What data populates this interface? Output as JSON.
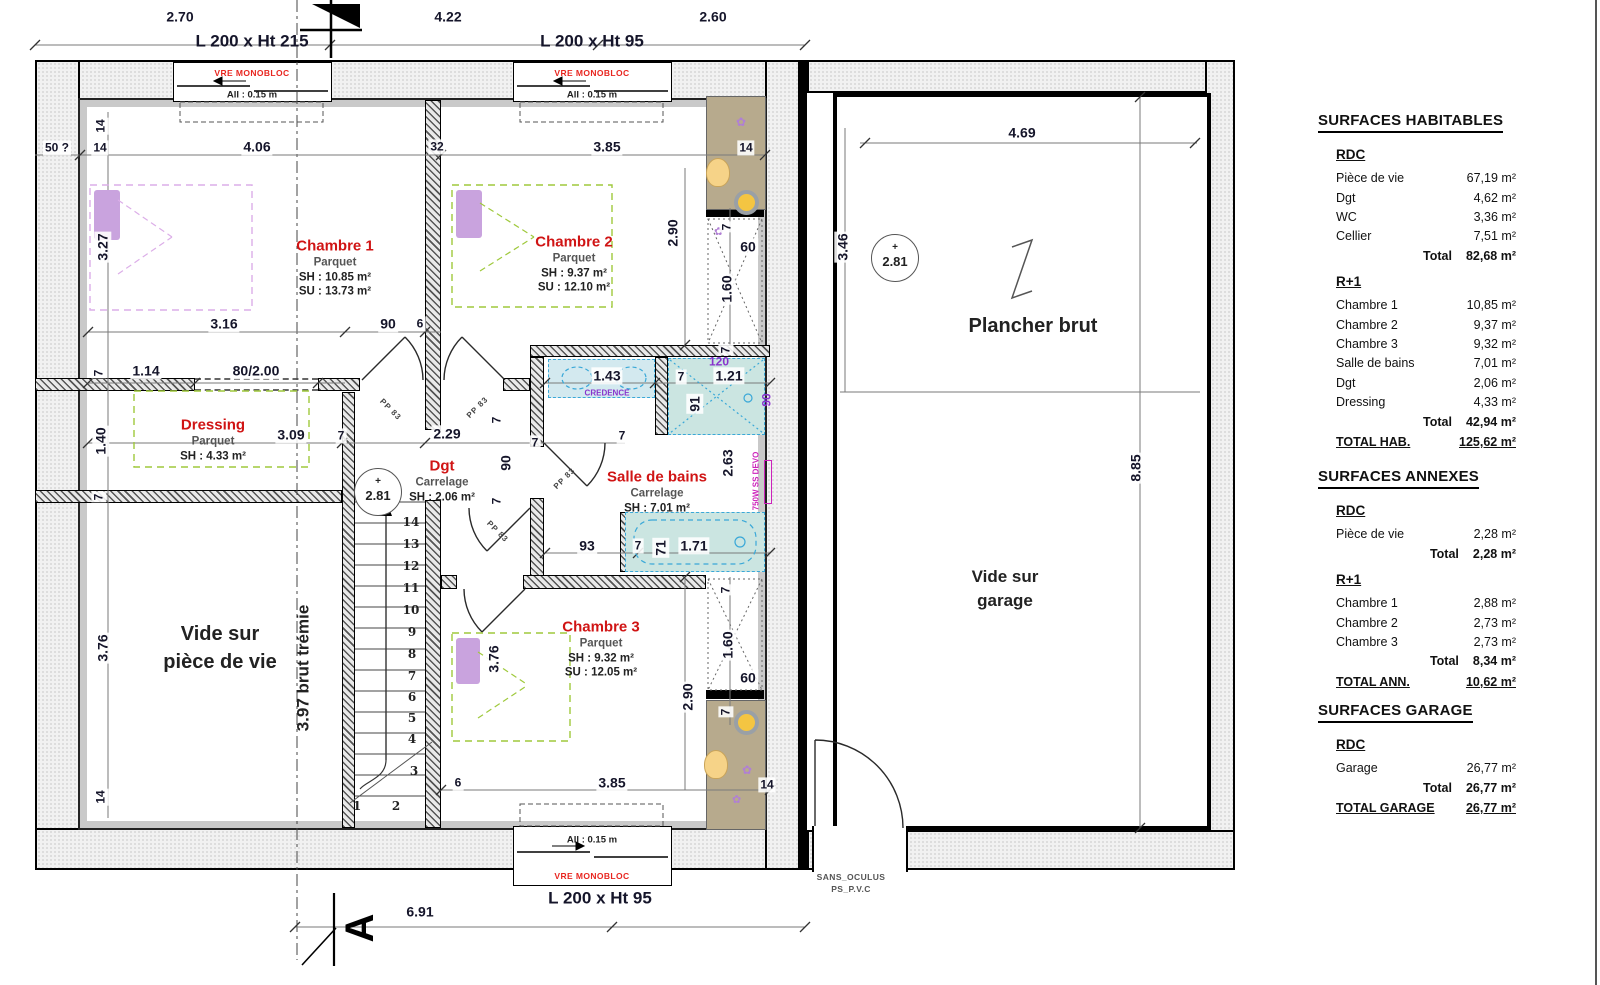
{
  "colors": {
    "room_label": "#d01414",
    "dim_text": "#15152a",
    "window_note": "#e8251f",
    "magenta": "#cc22bb",
    "purple": "#8833cc",
    "teal_fill": "#cbe5e1",
    "tan_fill": "#b7aa8d",
    "green_dash": "#9fc93c",
    "bed_purple": "#c9a3de",
    "blue_dash": "#3aa8d8"
  },
  "tables": {
    "hab": {
      "title": "SURFACES HABITABLES",
      "s0": {
        "h": "RDC",
        "rows": [
          {
            "l": "Pièce de vie",
            "v": "67,19 m²"
          },
          {
            "l": "Dgt",
            "v": "4,62 m²"
          },
          {
            "l": "WC",
            "v": "3,36 m²"
          },
          {
            "l": "Cellier",
            "v": "7,51 m²"
          }
        ],
        "tl": "Total",
        "tv": "82,68 m²"
      },
      "s1": {
        "h": "R+1",
        "rows": [
          {
            "l": "Chambre 1",
            "v": "10,85 m²"
          },
          {
            "l": "Chambre 2",
            "v": "9,37 m²"
          },
          {
            "l": "Chambre 3",
            "v": "9,32 m²"
          },
          {
            "l": "Salle de bains",
            "v": "7,01 m²"
          },
          {
            "l": "Dgt",
            "v": "2,06 m²"
          },
          {
            "l": "Dressing",
            "v": "4,33 m²"
          }
        ],
        "tl": "Total",
        "tv": "42,94 m²"
      },
      "gl": "TOTAL HAB.",
      "gv": "125,62 m²"
    },
    "ann": {
      "title": "SURFACES ANNEXES",
      "s0": {
        "h": "RDC",
        "rows": [
          {
            "l": "Pièce de vie",
            "v": "2,28 m²"
          }
        ],
        "tl": "Total",
        "tv": "2,28 m²"
      },
      "s1": {
        "h": "R+1",
        "rows": [
          {
            "l": "Chambre 1",
            "v": "2,88 m²"
          },
          {
            "l": "Chambre 2",
            "v": "2,73 m²"
          },
          {
            "l": "Chambre 3",
            "v": "2,73 m²"
          }
        ],
        "tl": "Total",
        "tv": "8,34 m²"
      },
      "gl": "TOTAL ANN.",
      "gv": "10,62 m²"
    },
    "gar": {
      "title": "SURFACES GARAGE",
      "s0": {
        "h": "RDC",
        "rows": [
          {
            "l": "Garage",
            "v": "26,77 m²"
          }
        ],
        "tl": "Total",
        "tv": "26,77 m²"
      },
      "gl": "TOTAL GARAGE",
      "gv": "26,77 m²"
    }
  },
  "plan": {
    "rooms": [
      {
        "name": "Chambre 1",
        "material": "Parquet",
        "line1": "SH : 10.85 m²",
        "line2": "SU : 13.73 m²",
        "x": 335,
        "y": 268
      },
      {
        "name": "Chambre 2",
        "material": "Parquet",
        "line1": "SH : 9.37 m²",
        "line2": "SU : 12.10 m²",
        "x": 574,
        "y": 264
      },
      {
        "name": "Chambre 3",
        "material": "Parquet",
        "line1": "SH : 9.32 m²",
        "line2": "SU : 12.05 m²",
        "x": 601,
        "y": 649
      },
      {
        "name": "Dressing",
        "material": "Parquet",
        "line1": "SH : 4.33 m²",
        "x": 213,
        "y": 440
      },
      {
        "name": "Dgt",
        "material": "Carrelage",
        "line1": "SH : 2.06 m²",
        "x": 442,
        "y": 481
      },
      {
        "name": "Salle de bains",
        "material": "Carrelage",
        "line1": "SH : 7.01 m²",
        "x": 657,
        "y": 492
      }
    ],
    "vide_piece": {
      "l1": "Vide sur",
      "l2": "pièce de vie"
    },
    "plancher": "Plancher brut",
    "vide_garage": {
      "l1": "Vide sur",
      "l2": "garage"
    },
    "tremie": "3.97 brut trémie",
    "door_exit": {
      "l1": "SANS_OCULUS",
      "l2": "PS_P.V.C"
    },
    "level": {
      "plus": "+",
      "value": "2.81"
    },
    "section_letter": "A",
    "windows": {
      "w1": {
        "size": "L 200 x Ht 215",
        "type": "VRE MONOBLOC",
        "sill": "All : 0.15 m"
      },
      "w2": {
        "size": "L 200 x Ht 95",
        "type": "VRE MONOBLOC",
        "sill": "All : 0.15 m"
      },
      "w3": {
        "size": "L 200 x Ht 95",
        "type": "VRE MONOBLOC",
        "sill": "All : 0.15 m"
      }
    },
    "stair_numbers": [
      {
        "t": "1",
        "x": 357,
        "y": 806
      },
      {
        "t": "2",
        "x": 396,
        "y": 806
      },
      {
        "t": "3",
        "x": 414,
        "y": 771
      },
      {
        "t": "4",
        "x": 412,
        "y": 739
      },
      {
        "t": "5",
        "x": 412,
        "y": 718
      },
      {
        "t": "6",
        "x": 412,
        "y": 697
      },
      {
        "t": "7",
        "x": 412,
        "y": 676
      },
      {
        "t": "8",
        "x": 412,
        "y": 654
      },
      {
        "t": "9",
        "x": 412,
        "y": 632
      },
      {
        "t": "10",
        "x": 411,
        "y": 610
      },
      {
        "t": "11",
        "x": 411,
        "y": 588
      },
      {
        "t": "12",
        "x": 411,
        "y": 566
      },
      {
        "t": "13",
        "x": 411,
        "y": 544
      },
      {
        "t": "14",
        "x": 411,
        "y": 522
      }
    ],
    "dims": [
      {
        "t": "2.70",
        "x": 180,
        "y": 17
      },
      {
        "t": "4.22",
        "x": 448,
        "y": 17
      },
      {
        "t": "2.60",
        "x": 713,
        "y": 17
      },
      {
        "t": "50 ?",
        "x": 57,
        "y": 148,
        "c": "sm"
      },
      {
        "t": "14",
        "x": 100,
        "y": 148,
        "c": "sm"
      },
      {
        "t": "4.06",
        "x": 257,
        "y": 147
      },
      {
        "t": "32",
        "x": 437,
        "y": 147,
        "c": "sm"
      },
      {
        "t": "3.85",
        "x": 607,
        "y": 147
      },
      {
        "t": "14",
        "x": 746,
        "y": 148,
        "c": "sm"
      },
      {
        "t": "14",
        "x": 101,
        "y": 126,
        "r": -90,
        "c": "sm"
      },
      {
        "t": "3.27",
        "x": 103,
        "y": 247,
        "r": -90
      },
      {
        "t": "7",
        "x": 99,
        "y": 373,
        "r": -90,
        "c": "sm"
      },
      {
        "t": "1.40",
        "x": 101,
        "y": 441,
        "r": -90
      },
      {
        "t": "7",
        "x": 99,
        "y": 497,
        "r": -90,
        "c": "sm"
      },
      {
        "t": "3.76",
        "x": 103,
        "y": 648,
        "r": -90
      },
      {
        "t": "14",
        "x": 101,
        "y": 797,
        "r": -90,
        "c": "sm"
      },
      {
        "t": "3.16",
        "x": 224,
        "y": 324
      },
      {
        "t": "90",
        "x": 388,
        "y": 324
      },
      {
        "t": "6",
        "x": 420,
        "y": 324,
        "c": "sm"
      },
      {
        "t": "1.14",
        "x": 146,
        "y": 371
      },
      {
        "t": "80/2.00",
        "x": 256,
        "y": 371
      },
      {
        "t": "3.09",
        "x": 291,
        "y": 435
      },
      {
        "t": "7",
        "x": 341,
        "y": 436,
        "c": "sm"
      },
      {
        "t": "2.29",
        "x": 447,
        "y": 434
      },
      {
        "t": "90",
        "x": 506,
        "y": 463,
        "r": -90
      },
      {
        "t": "7",
        "x": 497,
        "y": 420,
        "r": -90,
        "c": "sm"
      },
      {
        "t": "7",
        "x": 497,
        "y": 501,
        "r": -90,
        "c": "sm"
      },
      {
        "t": "7",
        "x": 622,
        "y": 436,
        "c": "sm"
      },
      {
        "t": "7",
        "x": 535,
        "y": 443,
        "c": "sm"
      },
      {
        "t": "1.43",
        "x": 607,
        "y": 376
      },
      {
        "t": "7",
        "x": 681,
        "y": 377,
        "c": "sm"
      },
      {
        "t": "1.21",
        "x": 729,
        "y": 376
      },
      {
        "t": "91",
        "x": 695,
        "y": 404,
        "r": -90
      },
      {
        "t": "120",
        "x": 719,
        "y": 362,
        "c": "pur sm"
      },
      {
        "t": "90",
        "x": 767,
        "y": 400,
        "r": -90,
        "c": "pur sm"
      },
      {
        "t": "CREDENCE",
        "x": 607,
        "y": 394,
        "c": "pur tiny"
      },
      {
        "t": "2.90",
        "x": 673,
        "y": 233,
        "r": -90
      },
      {
        "t": "7",
        "x": 727,
        "y": 227,
        "r": -90,
        "c": "sm"
      },
      {
        "t": "60",
        "x": 748,
        "y": 247
      },
      {
        "t": "1.60",
        "x": 727,
        "y": 289,
        "r": -90
      },
      {
        "t": "7",
        "x": 726,
        "y": 350,
        "r": -90,
        "c": "sm"
      },
      {
        "t": "2.63",
        "x": 728,
        "y": 463,
        "r": -90
      },
      {
        "t": "93",
        "x": 587,
        "y": 546
      },
      {
        "t": "7",
        "x": 638,
        "y": 546,
        "c": "sm"
      },
      {
        "t": "71",
        "x": 661,
        "y": 548,
        "r": -90
      },
      {
        "t": "1.71",
        "x": 694,
        "y": 546
      },
      {
        "t": "750W SS DEVO",
        "x": 757,
        "y": 481,
        "r": -90,
        "c": "mag tiny"
      },
      {
        "t": "3.76",
        "x": 494,
        "y": 659,
        "r": -90
      },
      {
        "t": "2.90",
        "x": 688,
        "y": 697,
        "r": -90
      },
      {
        "t": "1.60",
        "x": 728,
        "y": 645,
        "r": -90
      },
      {
        "t": "60",
        "x": 748,
        "y": 678
      },
      {
        "t": "7",
        "x": 726,
        "y": 712,
        "r": -90,
        "c": "sm"
      },
      {
        "t": "7",
        "x": 726,
        "y": 590,
        "r": -90,
        "c": "sm"
      },
      {
        "t": "6",
        "x": 458,
        "y": 783,
        "c": "sm"
      },
      {
        "t": "3.85",
        "x": 612,
        "y": 783
      },
      {
        "t": "14",
        "x": 767,
        "y": 785,
        "c": "sm"
      },
      {
        "t": "6.91",
        "x": 420,
        "y": 912
      },
      {
        "t": "4.69",
        "x": 1022,
        "y": 133
      },
      {
        "t": "3.46",
        "x": 843,
        "y": 247,
        "r": -90
      },
      {
        "t": "8.85",
        "x": 1136,
        "y": 468,
        "r": -90
      },
      {
        "t": "PP 83",
        "x": 390,
        "y": 410,
        "r": 45,
        "c": "door"
      },
      {
        "t": "PP 83",
        "x": 478,
        "y": 408,
        "r": -45,
        "c": "door"
      },
      {
        "t": "PP 83",
        "x": 497,
        "y": 532,
        "r": 45,
        "c": "door"
      },
      {
        "t": "PP 83",
        "x": 565,
        "y": 479,
        "r": -45,
        "c": "door"
      }
    ]
  }
}
